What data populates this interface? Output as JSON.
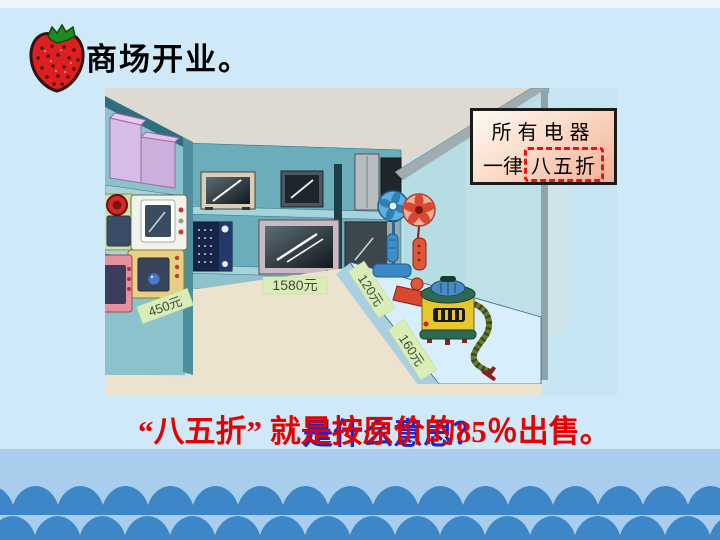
{
  "header": {
    "title": "商场开业。"
  },
  "sign": {
    "line1": "所有电器",
    "line2_prefix": "一律",
    "line2_highlight": "八五折",
    "highlight_border_color": "#ee1111"
  },
  "price_tags": {
    "green_microwave": "450元",
    "big_tv": "1580元",
    "blue_fan": "120元",
    "red_fan": "160元"
  },
  "caption": {
    "question": "是什么意思？",
    "answer": "“八五折” 就是按原价的85％出售。",
    "question_color": "#2222cc",
    "answer_color": "#e60000"
  },
  "waves": {
    "bump_color": "#3d87c8",
    "strip_color": "#a9cdec"
  }
}
